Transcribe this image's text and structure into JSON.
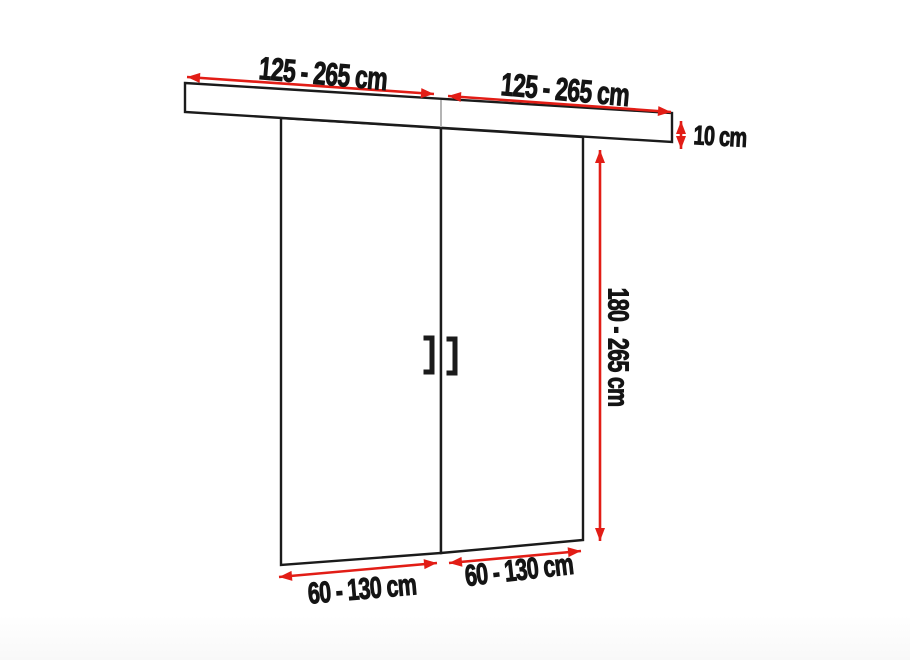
{
  "diagram": {
    "type": "sliding-double-door-dimension-diagram",
    "background": "#ffffff",
    "colors": {
      "outline": "#1b1b1b",
      "arrow": "#e21d16",
      "text": "#141414",
      "rail_panel_divider": "#b4b4b4",
      "panel_fill": "#ffffff"
    },
    "labels": {
      "rail_width_left": "125 - 265 cm",
      "rail_width_right": "125 - 265 cm",
      "rail_height": "10 cm",
      "door_height": "180 - 265 cm",
      "door_width_left": "60 - 130 cm",
      "door_width_right": "60 - 130 cm"
    }
  }
}
